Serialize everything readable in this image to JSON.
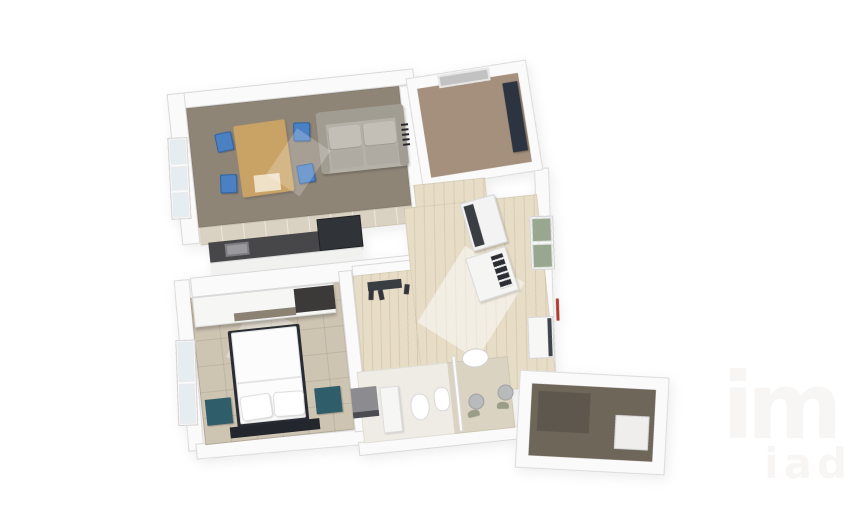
{
  "scene": {
    "description": "3D rendered top-down floor plan of an apartment on a white background",
    "background": "#ffffff",
    "watermark": {
      "logo_text": "im",
      "sub_text": "iad"
    }
  },
  "colors": {
    "wall_white": "#fafafa",
    "wall_shade": "#d9d9d9",
    "living_floor": "#8f8577",
    "tile_floor": "#d9d1c1",
    "bedroom_floor": "#cec4b2",
    "office_floor": "#a5907e",
    "wood_floor": "#e7ddc7",
    "entry_floor": "#6f665a",
    "counter_dark": "#47474a",
    "appliance_dark": "#303338",
    "navy_cabinet": "#2b3440",
    "teal": "#2f5d69",
    "chair_blue": "#4b80c2",
    "table_wood": "#c9a265",
    "sofa_gray": "#b6b1a8",
    "sofa_dark": "#a29d93",
    "glass_blue": "#e6edf1",
    "glass_green": "#98a78f",
    "red_accent": "#b23b30",
    "bed_white": "#fcfcfd",
    "bed_frame": "#2a2c33",
    "gray_box": "#8c8c90",
    "plant_green": "#8a9078",
    "watermark": "#f7f6f4"
  },
  "rooms": [
    {
      "name": "living-room",
      "floor": "gray-brown",
      "furniture": [
        "dining-table",
        "blue-chair x4",
        "sofa"
      ]
    },
    {
      "name": "kitchen",
      "floor": "beige-tile",
      "furniture": [
        "counter",
        "sink",
        "cooktop-oven"
      ]
    },
    {
      "name": "bedroom",
      "floor": "beige-tile",
      "furniture": [
        "double-bed",
        "pillows x2",
        "nightstand x2",
        "wardrobe",
        "rug"
      ]
    },
    {
      "name": "office-room",
      "floor": "brown",
      "furniture": [
        "navy-cabinet",
        "door-recess"
      ]
    },
    {
      "name": "hallway",
      "floor": "light-wood",
      "furniture": [
        "washing-machine",
        "console-table",
        "shoes"
      ]
    },
    {
      "name": "bathroom",
      "floor": "white-beige",
      "furniture": [
        "toilet",
        "bidet",
        "wall-sink",
        "shower-screen",
        "pedestal-basin x2",
        "plants",
        "laundry-box",
        "tall-cabinet"
      ]
    },
    {
      "name": "entry-landing",
      "floor": "dark-brown",
      "furniture": [
        "door-mat",
        "step"
      ]
    }
  ],
  "windows": {
    "left_glass": "pale-blue",
    "right_glass": "green",
    "accent": "red-line-on-right-wall"
  }
}
